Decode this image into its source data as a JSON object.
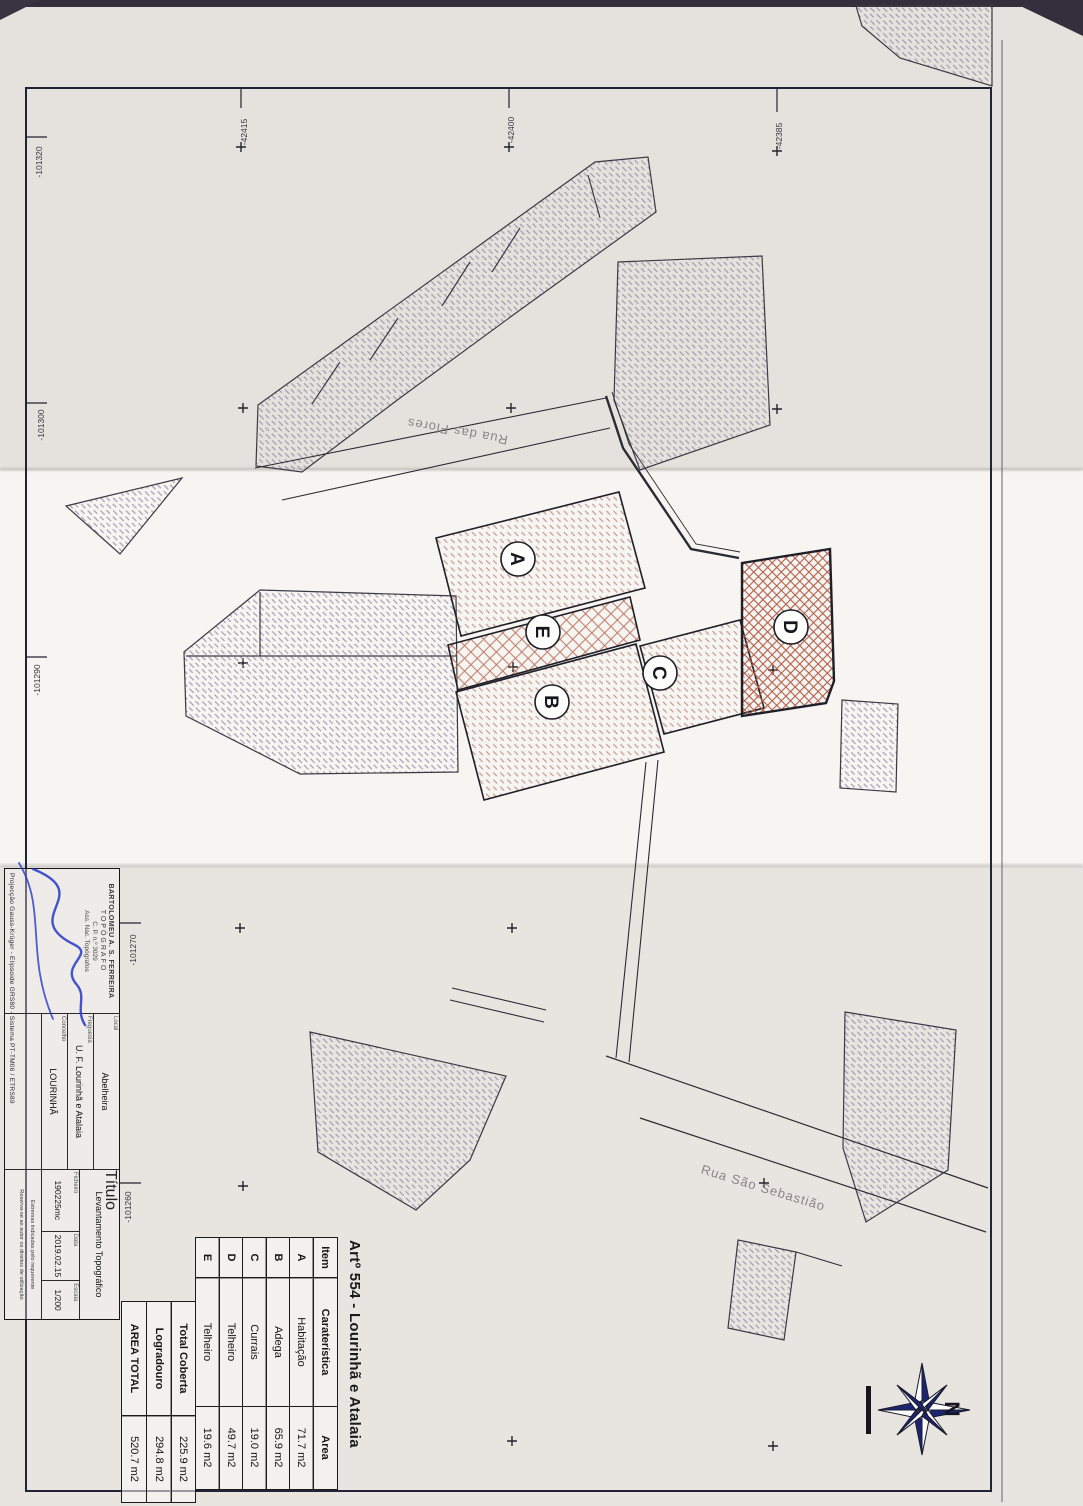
{
  "document": {
    "title": "Artº 554 - Lourinhã e Atalaia",
    "table": {
      "columns": [
        "Item",
        "Caraterística",
        "Area"
      ],
      "rows": [
        {
          "item": "A",
          "caracteristica": "Habitação",
          "area": "71.7 m2"
        },
        {
          "item": "B",
          "caracteristica": "Adega",
          "area": "65.9 m2"
        },
        {
          "item": "C",
          "caracteristica": "Currais",
          "area": "19.0 m2"
        },
        {
          "item": "D",
          "caracteristica": "Telheiro",
          "area": "49.7 m2"
        },
        {
          "item": "E",
          "caracteristica": "Telheiro",
          "area": "19.6 m2"
        }
      ],
      "summary": [
        {
          "label": "Total Coberta",
          "area": "225.9 m2"
        },
        {
          "label": "Logradouro",
          "area": "294.8 m2"
        },
        {
          "label": "AREA TOTAL",
          "area": "520.7 m2"
        }
      ]
    },
    "title_block": {
      "stamp": {
        "name": "BARTOLOMEU A. S. FERREIRA",
        "role": "TOPÓGRAFO",
        "license": "C. P. n.º 3029",
        "org": "Ass. Nac. Topógrafos"
      },
      "projection": "Projecção Gauss-Krüger - Elipsoide GRS80 - Sistema PT-TM06 / ETRS89",
      "fields": [
        {
          "label": "Local",
          "value": "Abelheira"
        },
        {
          "label": "Freguesia",
          "value": "U. F. Lourinhã e Atalaia"
        },
        {
          "label": "Concelho",
          "value": "LOURINHÃ"
        },
        {
          "label": "Título",
          "value": "Levantamento Topográfico"
        },
        {
          "label": "Ficheiro",
          "value": "190225mc"
        },
        {
          "label": "Data",
          "value": "2019.02.15"
        },
        {
          "label": "Escala",
          "value": "1/200"
        }
      ],
      "notes": [
        "Estremas indicadas pelo requerente",
        "Reserva-se ao autor os direitos de utilização"
      ]
    },
    "plan": {
      "building_labels": [
        "A",
        "B",
        "C",
        "D",
        "E"
      ],
      "streets": [
        "Rua das Flores",
        "Rua São Sebastião"
      ],
      "grid_labels_left": [
        "-101320",
        "-101300",
        "-101290",
        "-101270",
        "-101260"
      ],
      "grid_labels_top": [
        "-42415",
        "-42400",
        "-42385"
      ],
      "compass_north": "N"
    },
    "colors": {
      "ink": "#23232e",
      "hatch_grey": "#8f8aa0",
      "hatch_pink": "#c28e85",
      "hatch_red": "#b05f4b",
      "signature_blue": "#2438c8"
    }
  }
}
